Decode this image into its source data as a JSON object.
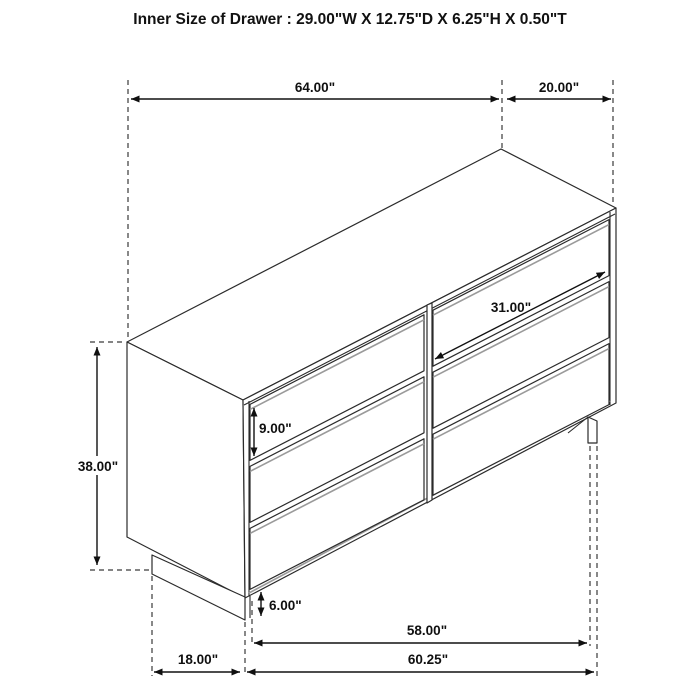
{
  "labels": {
    "title": "Inner Size of Drawer : 29.00\"W X 12.75\"D X 6.25\"H X 0.50\"T",
    "w64": "64.00\"",
    "d20": "20.00\"",
    "h38": "38.00\"",
    "w31": "31.00\"",
    "h9": "9.00\"",
    "h6": "6.00\"",
    "w58": "58.00\"",
    "w6025": "60.25\"",
    "d18": "18.00\""
  },
  "figure": {
    "type": "furniture-dimension-diagram",
    "item": "six-drawer dresser, isometric line drawing",
    "drawer_count": 6,
    "dimensions": {
      "inner_drawer": "29.00\"W X 12.75\"D X 6.25\"H X 0.50\"T",
      "top_width": "64.00\"",
      "top_depth": "20.00\"",
      "overall_height": "38.00\"",
      "drawer_front_width": "31.00\"",
      "drawer_front_height": "9.00\"",
      "base_height": "6.00\"",
      "base_front_width": "58.00\"",
      "overall_front_width_at_floor": "60.25\"",
      "side_depth_at_floor": "18.00\""
    }
  }
}
